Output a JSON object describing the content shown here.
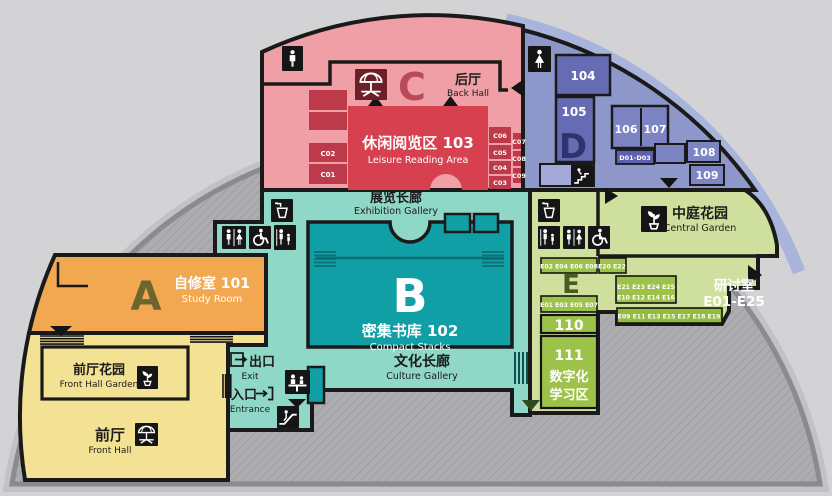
{
  "title": "library-floor-plan",
  "zones": {
    "back_hall": {
      "letter": "C",
      "cn": "后厅",
      "en": "Back Hall"
    },
    "leisure": {
      "cn": "休闲阅览区 103",
      "en": "Leisure Reading Area"
    },
    "c_rooms": [
      "C01",
      "C02",
      "C03",
      "C04",
      "C05",
      "C06",
      "C07",
      "C08",
      "C09"
    ],
    "exhibition": {
      "cn": "展览长廊",
      "en": "Exhibition Gallery"
    },
    "stacks": {
      "letter": "B",
      "cn": "密集书库 102",
      "en": "Compact Stacks"
    },
    "culture": {
      "cn": "文化长廊",
      "en": "Culture Gallery"
    },
    "study": {
      "letter": "A",
      "cn": "自修室 101",
      "en": "Study Room"
    },
    "front_hall_garden": {
      "cn": "前厅花园",
      "en": "Front Hall Garden"
    },
    "front_hall": {
      "cn": "前厅",
      "en": "Front Hall"
    },
    "exit": {
      "cn": "出口",
      "en": "Exit"
    },
    "entrance": {
      "cn": "入口",
      "en": "Entrance"
    },
    "d_zone": {
      "letter": "D",
      "rooms": {
        "r104": "104",
        "r105": "105",
        "r106": "106",
        "r107": "107",
        "r108": "108",
        "r109": "109",
        "d0103": "D01-D03"
      }
    },
    "central_garden": {
      "cn": "中庭花园",
      "en": "Central Garden"
    },
    "e_zone": {
      "letter": "E",
      "seminar_cn": "研讨室",
      "seminar_range": "E01-E25",
      "strip_even": "E02 E04 E06 E08",
      "strip_2022": "E20 E22",
      "mid_row1": "E21 E23 E24 E25",
      "mid_row2": "E10 E12 E14 E16",
      "strip_odd": "E01 E03 E05 E07",
      "strip_bottom": "E09 E11 E13 E15 E17 E18 E19",
      "r110": "110",
      "r111": "111",
      "digital_line1": "数字化",
      "digital_line2": "学习区"
    }
  },
  "icons": [
    "mens-restroom-icon",
    "womens-restroom-icon",
    "restroom-icon",
    "wheelchair-icon",
    "family-restroom-icon",
    "water-fountain-icon",
    "sprout-icon",
    "parasol-table-icon",
    "info-desk-icon",
    "escalator-icon",
    "stairs-icon",
    "exit-door-icon",
    "entrance-arrow-icon",
    "door-arrow-icon"
  ],
  "colors": {
    "background": "#d3d3d6",
    "dome_fill": "#acacb1",
    "dome_hatch": "#9a9aa0",
    "dome_edge": "#8a8a8f",
    "blue_band": "#a9b4dc",
    "wall": "#1a1a1a",
    "pink_zone": "#f09fa7",
    "red_room": "#d7404f",
    "dark_red_room": "#bc3a49",
    "teal_corridor": "#8fd7c7",
    "teal_room": "#119fa6",
    "purple_zone": "#8e97c9",
    "purple_room": "#666cb3",
    "purple_room_light": "#7d84c4",
    "green_zone": "#cfe09e",
    "green_room": "#9dc24a",
    "orange_zone": "#f2a851",
    "yellow_zone": "#f3e294"
  }
}
